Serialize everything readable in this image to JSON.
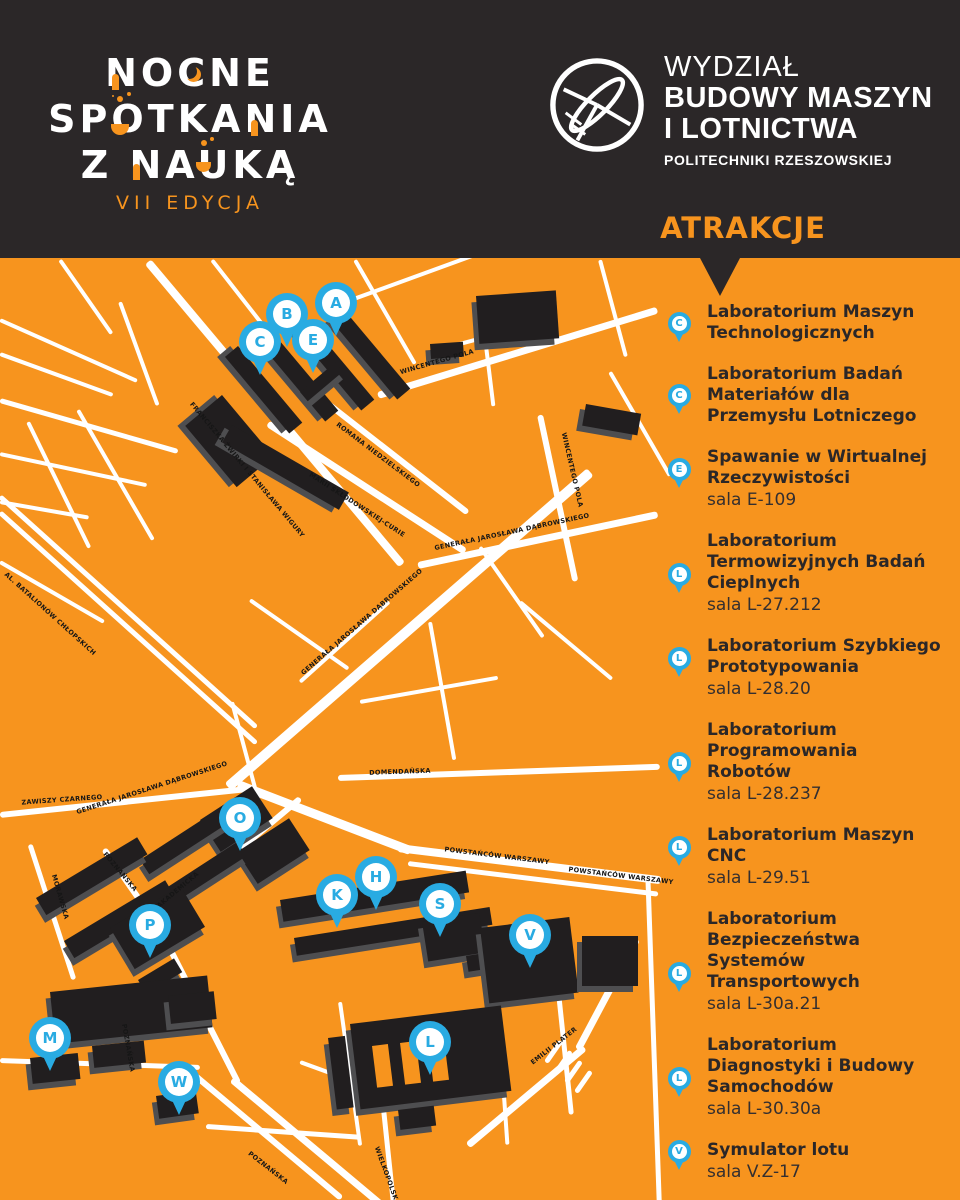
{
  "header": {
    "event_logo": {
      "line1": "NOCNE",
      "line2": "SPOTKANIA",
      "line3": "Z NAUKĄ",
      "edition": "VII EDYCJA"
    },
    "faculty": {
      "line1": "WYDZIAŁ",
      "line2": "BUDOWY MASZYN",
      "line3": "I LOTNICTWA",
      "line4": "POLITECHNIKI RZESZOWSKIEJ"
    },
    "attractions_title": "ATRAKCJE"
  },
  "colors": {
    "orange": "#F7941E",
    "dark": "#2B2728",
    "pin_blue": "#29ABE2",
    "building": "#211E1F",
    "street_white": "#FFFFFF"
  },
  "map": {
    "pins": [
      {
        "letter": "A",
        "x": 336,
        "y": 45
      },
      {
        "letter": "B",
        "x": 287,
        "y": 56
      },
      {
        "letter": "C",
        "x": 260,
        "y": 84
      },
      {
        "letter": "E",
        "x": 313,
        "y": 82
      },
      {
        "letter": "O",
        "x": 240,
        "y": 560
      },
      {
        "letter": "H",
        "x": 376,
        "y": 619
      },
      {
        "letter": "K",
        "x": 337,
        "y": 637
      },
      {
        "letter": "S",
        "x": 440,
        "y": 646
      },
      {
        "letter": "V",
        "x": 530,
        "y": 677
      },
      {
        "letter": "P",
        "x": 150,
        "y": 667
      },
      {
        "letter": "M",
        "x": 50,
        "y": 780
      },
      {
        "letter": "W",
        "x": 179,
        "y": 824
      },
      {
        "letter": "L",
        "x": 430,
        "y": 784
      }
    ],
    "street_labels": [
      {
        "text": "FRANCISZKA ŻWIRKI I STANISŁAWA WIGURY",
        "x": 247,
        "y": 212,
        "rot": 50
      },
      {
        "text": "MARII SKŁODOWSKIEJ-CURIE",
        "x": 357,
        "y": 247,
        "rot": 33
      },
      {
        "text": "ROMANA NIEDZIELSKIEGO",
        "x": 378,
        "y": 197,
        "rot": 37
      },
      {
        "text": "WINCENTEGO POLA",
        "x": 437,
        "y": 104,
        "rot": -16
      },
      {
        "text": "WINCENTEGO POLA",
        "x": 572,
        "y": 212,
        "rot": 77
      },
      {
        "text": "GENERAŁA JAROSŁAWA DĄBROWSKIEGO",
        "x": 362,
        "y": 364,
        "rot": -41
      },
      {
        "text": "GENERAŁA JAROSŁAWA DĄBROWSKIEGO",
        "x": 512,
        "y": 274,
        "rot": -12
      },
      {
        "text": "AL. BATALIONÓW CHŁOPSKICH",
        "x": 50,
        "y": 356,
        "rot": 42
      },
      {
        "text": "ZAWISZY CZARNEGO",
        "x": 62,
        "y": 542,
        "rot": -4
      },
      {
        "text": "GENERAŁA JAROSŁAWA DĄBROWSKIEGO",
        "x": 152,
        "y": 530,
        "rot": -18
      },
      {
        "text": "DOMENDAŃSKA",
        "x": 400,
        "y": 514,
        "rot": -2
      },
      {
        "text": "POWSTAŃCÓW WARSZAWY",
        "x": 497,
        "y": 598,
        "rot": 7
      },
      {
        "text": "POWSTAŃCÓW WARSZAWY",
        "x": 621,
        "y": 618,
        "rot": 7
      },
      {
        "text": "POZNAŃSKA",
        "x": 120,
        "y": 614,
        "rot": 50
      },
      {
        "text": "AKADEMICKA",
        "x": 178,
        "y": 632,
        "rot": -40
      },
      {
        "text": "MORAWSKA",
        "x": 60,
        "y": 639,
        "rot": 74
      },
      {
        "text": "POZNAŃSKA",
        "x": 128,
        "y": 790,
        "rot": 80
      },
      {
        "text": "POZNAŃSKA",
        "x": 268,
        "y": 910,
        "rot": 38
      },
      {
        "text": "WIELKOPOLSKA",
        "x": 387,
        "y": 918,
        "rot": 70
      },
      {
        "text": "EMILII PLATER",
        "x": 554,
        "y": 788,
        "rot": -38
      }
    ]
  },
  "attractions": [
    {
      "pin": "C",
      "title": "Laboratorium Maszyn\nTechnologicznych"
    },
    {
      "pin": "C",
      "title": "Laboratorium Badań\nMateriałów dla\nPrzemysłu Lotniczego"
    },
    {
      "pin": "E",
      "title": "Spawanie w Wirtualnej\nRzeczywistości",
      "room": "sala E-109"
    },
    {
      "pin": "L",
      "title": "Laboratorium\nTermowizyjnych Badań\nCieplnych",
      "room": "sala L-27.212"
    },
    {
      "pin": "L",
      "title": "Laboratorium Szybkiego\nPrototypowania",
      "room": "sala L-28.20"
    },
    {
      "pin": "L",
      "title": "Laboratorium\nProgramowania\nRobotów",
      "room": "sala L-28.237"
    },
    {
      "pin": "L",
      "title": "Laboratorium Maszyn\nCNC",
      "room": "sala L-29.51"
    },
    {
      "pin": "L",
      "title": "Laboratorium\nBezpieczeństwa\nSystemów\nTransportowych",
      "room": "sala L-30a.21"
    },
    {
      "pin": "L",
      "title": "Laboratorium\nDiagnostyki i Budowy\nSamochodów",
      "room": "sala L-30.30a"
    },
    {
      "pin": "V",
      "title": "Symulator lotu",
      "room": "sala V.Z-17"
    }
  ]
}
